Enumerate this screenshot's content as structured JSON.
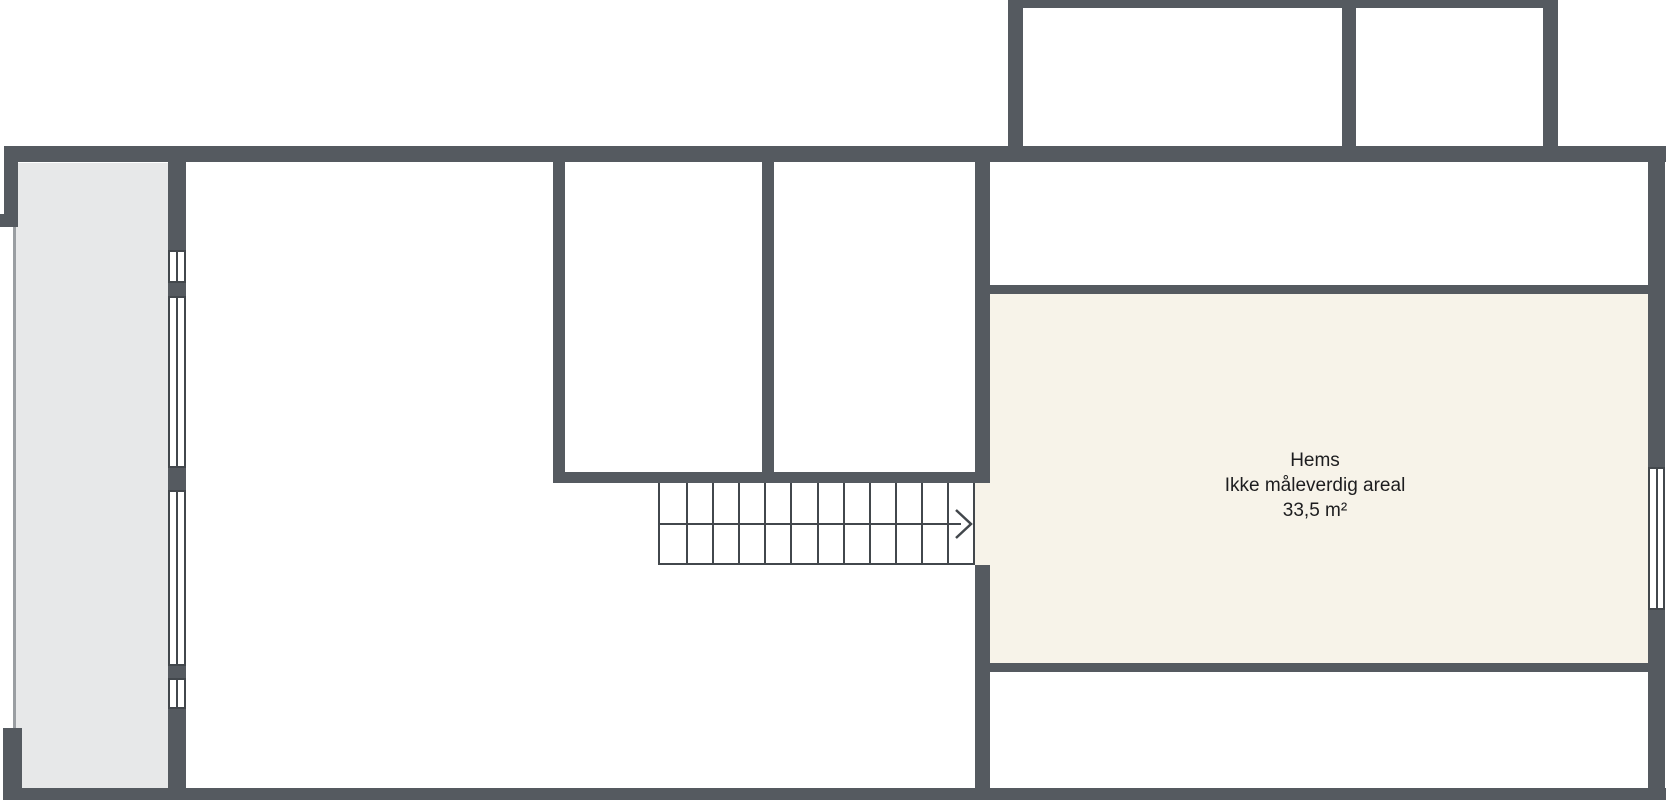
{
  "plan_title": "Hems floor plan",
  "room": {
    "name": "Hems",
    "note": "Ikke måleverdig areal",
    "area": "33,5 m²"
  },
  "stairs": {
    "steps": 12,
    "direction": "right",
    "arrow_icon": "stair-direction-arrow"
  },
  "windows": {
    "balcony_wall_count": 4,
    "right_wall_count": 1
  },
  "colors": {
    "wall": "#555a60",
    "line": "#42474c",
    "balcony_fill": "#e7e8e9",
    "hems_fill": "#f7f3e9",
    "railing": "#9a9ea2",
    "text": "#1d1d1f",
    "background": "#ffffff"
  }
}
